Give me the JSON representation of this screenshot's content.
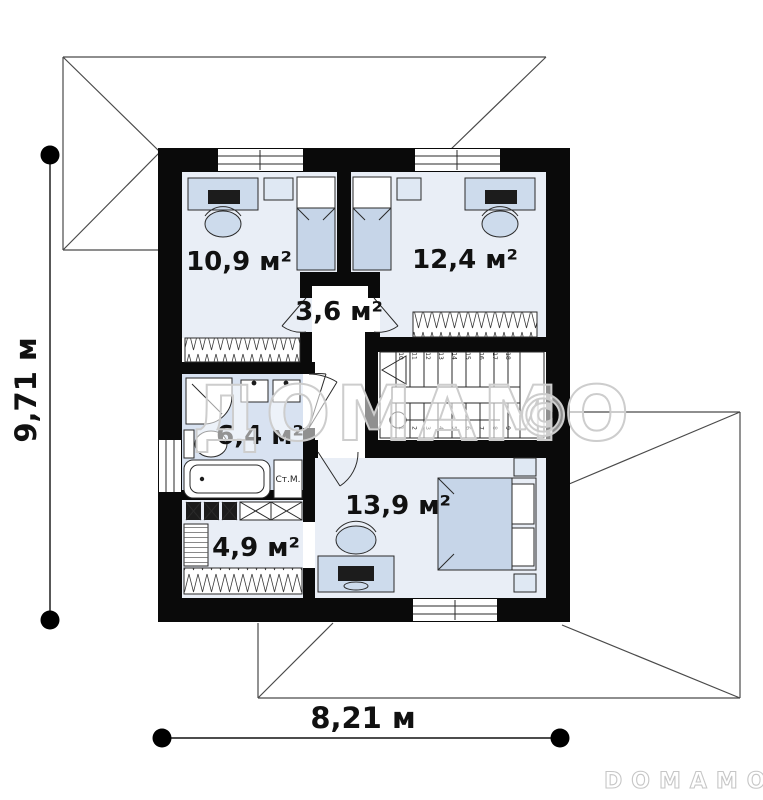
{
  "plan": {
    "rooms": [
      {
        "name": "bedroom-top-left",
        "area_label": "10,9 м²"
      },
      {
        "name": "bedroom-top-right",
        "area_label": "12,4 м²"
      },
      {
        "name": "hall",
        "area_label": "3,6 м²"
      },
      {
        "name": "bathroom",
        "area_label": "6,4 м²"
      },
      {
        "name": "bedroom-bottom",
        "area_label": "13,9 м²"
      },
      {
        "name": "wardrobe",
        "area_label": "4,9 м²"
      }
    ],
    "dimensions": {
      "height_label": "9,71 м",
      "width_label": "8,21 м"
    },
    "labels": {
      "washing_machine": "Ст.М."
    },
    "stairs": {
      "step_numbers_lower": [
        "1",
        "2",
        "3",
        "4",
        "5",
        "6",
        "7",
        "8",
        "9"
      ],
      "step_numbers_upper": [
        "10",
        "11",
        "12",
        "13",
        "14",
        "15",
        "16",
        "17",
        "18"
      ]
    },
    "watermark": {
      "text": "ДОМАМО",
      "copyright": "©",
      "logo": "DOMAMO"
    },
    "colors": {
      "wall": "#0a0a0a",
      "bedroom_floor": "#e9eef6",
      "bathroom_floor": "#d8e2f1",
      "furniture": "#cddbec",
      "roof_line": "#4a4a4a",
      "watermark_outline": "#cdcdcd"
    }
  }
}
